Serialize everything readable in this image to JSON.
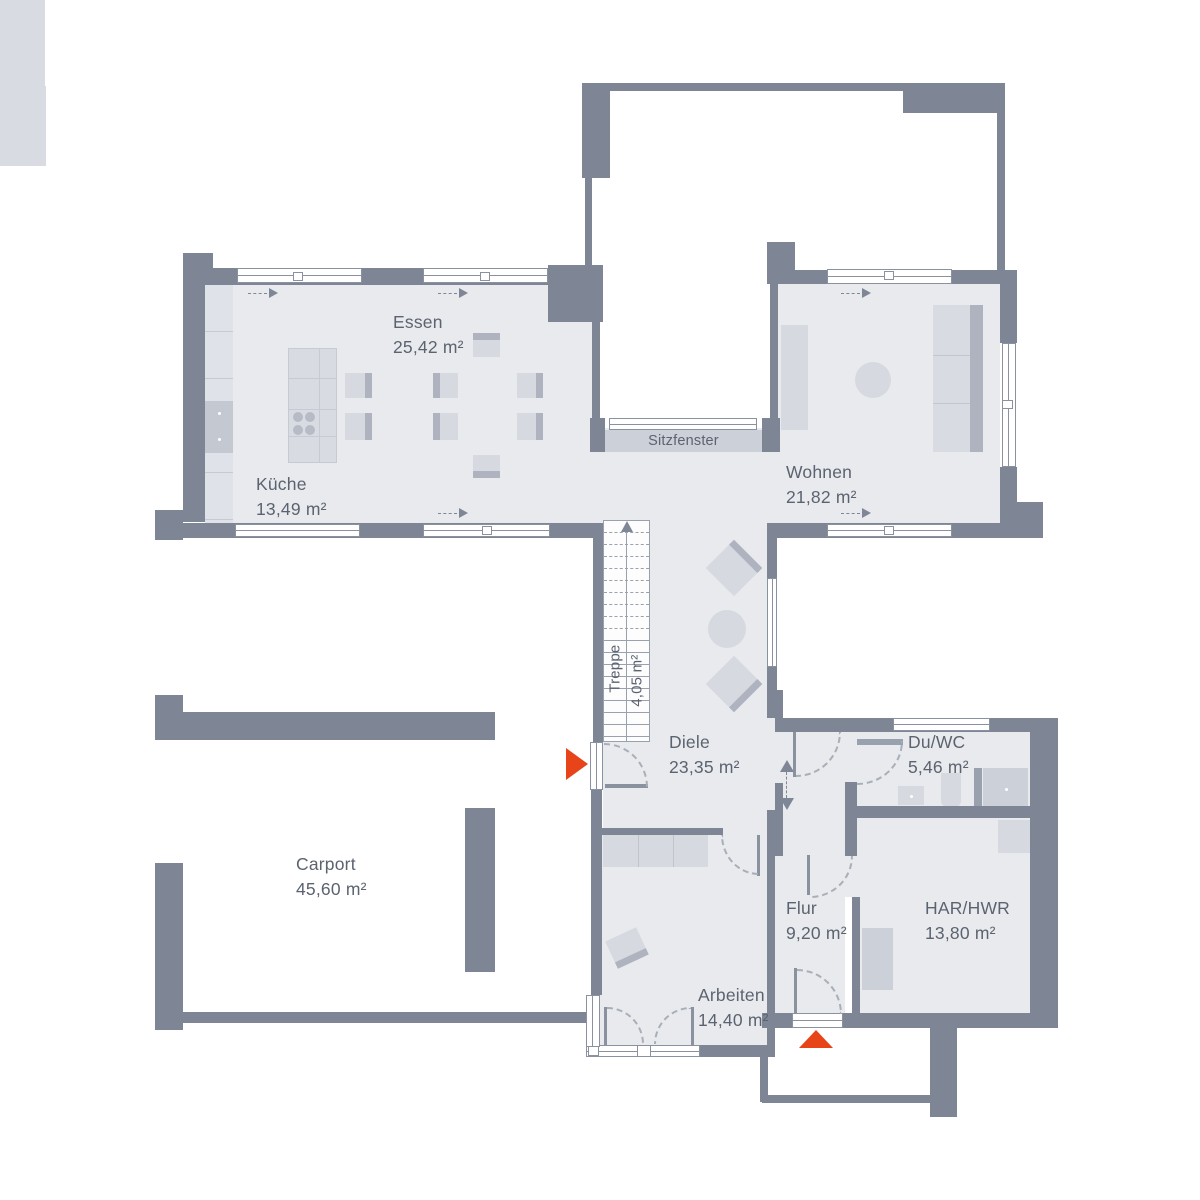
{
  "plan_title": "Erdgeschoss Grundriss",
  "rooms": {
    "essen": {
      "name": "Essen",
      "area": "25,42 m²"
    },
    "kueche": {
      "name": "Küche",
      "area": "13,49 m²"
    },
    "wohnen": {
      "name": "Wohnen",
      "area": "21,82 m²"
    },
    "sitzfenster": {
      "name": "Sitzfenster"
    },
    "treppe": {
      "name": "Treppe",
      "area": "4,05 m²"
    },
    "diele": {
      "name": "Diele",
      "area": "23,35 m²"
    },
    "duwc": {
      "name": "Du/WC",
      "area": "5,46 m²"
    },
    "carport": {
      "name": "Carport",
      "area": "45,60 m²"
    },
    "flur": {
      "name": "Flur",
      "area": "9,20 m²"
    },
    "harhwr": {
      "name": "HAR/HWR",
      "area": "13,80 m²"
    },
    "arbeiten": {
      "name": "Arbeiten",
      "area": "14,40 m²"
    }
  },
  "colors": {
    "wall": "#7e8695",
    "room_fill": "#e8eaee",
    "furniture": "#d6d9e0",
    "window_line": "#8a92a0",
    "entrance_arrow": "#e8441a",
    "text": "#5c6370"
  },
  "icons": {
    "entrance_arrow": "entrance-direction",
    "window_arrow": "window-opening-direction",
    "stair_arrow": "stair-up-direction"
  }
}
